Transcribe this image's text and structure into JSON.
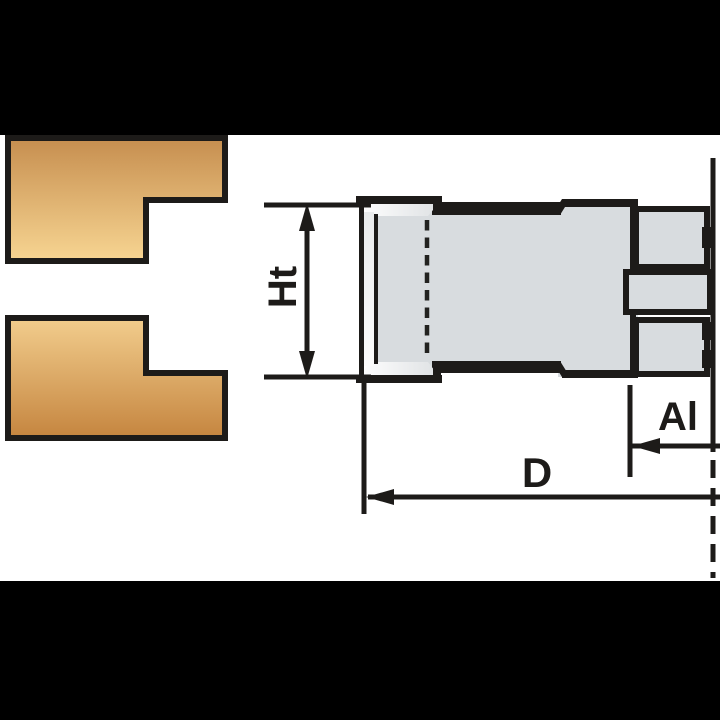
{
  "diagram": {
    "kind": "cutter-head-technical-drawing",
    "labels": {
      "ht": "Ht",
      "al": "Al",
      "d": "D"
    },
    "colors": {
      "letterbox": "#000000",
      "paper": "#ffffff",
      "outline": "#1d1b19",
      "body_fill": "#d8dcdf",
      "knife_strip_fill": "#f2f3f4",
      "wood_top_gradient_start": "#c68e4f",
      "wood_top_gradient_end": "#f7d592",
      "wood_bottom_gradient_start": "#f2cd8d",
      "wood_bottom_gradient_end": "#c5853f"
    }
  }
}
